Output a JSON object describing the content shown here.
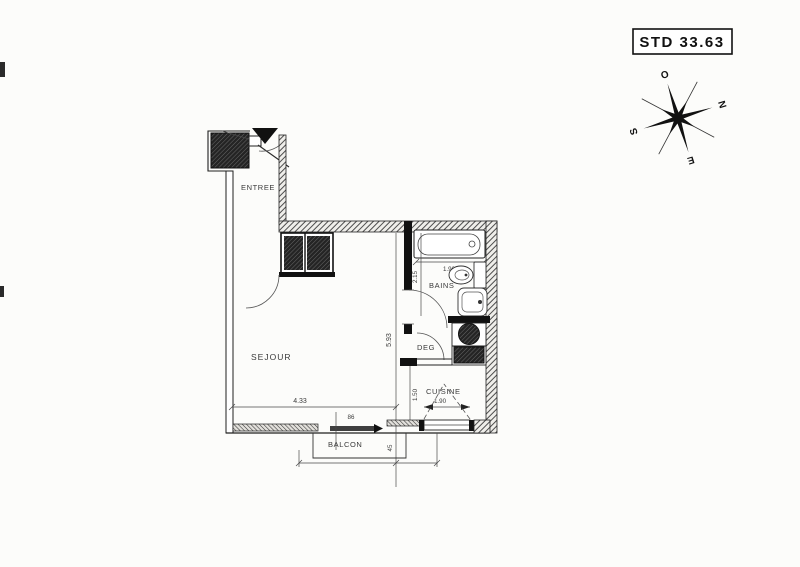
{
  "sheet": {
    "unit_label": "STD 33.63"
  },
  "compass": {
    "north": "N",
    "south": "S",
    "east": "E",
    "west": "O"
  },
  "rooms": {
    "entree": "ENTREE",
    "sejour": "SEJOUR",
    "bains": "BAINS",
    "deg": "DEG",
    "cuisine": "CUISINE",
    "balcon": "BALCON"
  },
  "dims": {
    "tub_width": "1.90",
    "bath_depth": "2.15",
    "sejour_width": "4.33",
    "sejour_depth": "5.93",
    "kitchen_depth": "1.50",
    "kitchen_width": "1.90",
    "bay_door_width": "86",
    "balcony_depth": "45"
  },
  "colors": {
    "ink": "#1f1f1f",
    "paper": "#fcfcfa"
  }
}
